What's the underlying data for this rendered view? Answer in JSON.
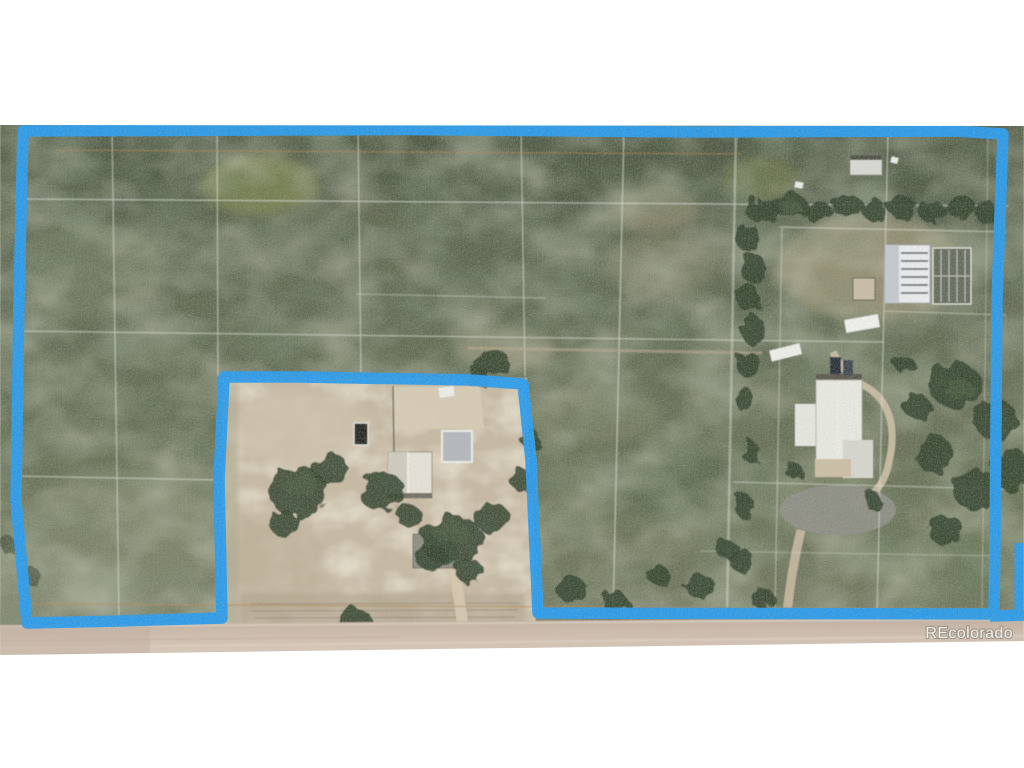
{
  "page": {
    "background_color": "#ffffff"
  },
  "photo": {
    "kind": "aerial-parcel-photograph",
    "watermark": "REcolorado",
    "boundary_color": "#2199ee",
    "palette": {
      "field_green_dark": "#4f5a44",
      "field_green_mid": "#5d6750",
      "field_green_light": "#6a7158",
      "homestead_dirt_tan": "#c7b9a2",
      "road_tan": "#cfbcac",
      "tree_green": "#2f3d2a",
      "survey_grid_line": "#e8ece4",
      "faint_track_orange": "#b5854d"
    },
    "features": [
      "blue property boundary outline with excluded homestead notch",
      "white survey parcel grid over pasture",
      "homestead with house, garage, sheds, trees and dirt driveway",
      "neighboring house with looping driveway",
      "storage buildings at upper right",
      "tree rows along east side",
      "dirt road along bottom edge"
    ]
  }
}
